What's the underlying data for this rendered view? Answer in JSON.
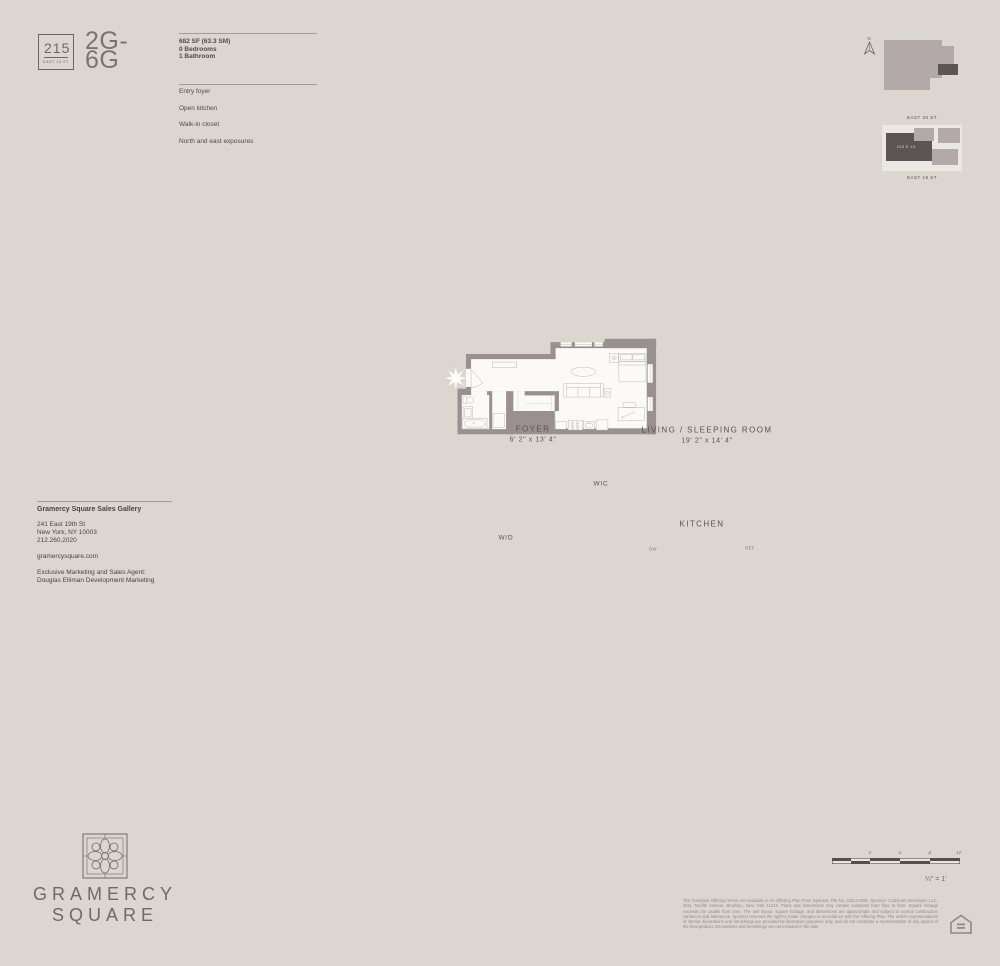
{
  "colors": {
    "background": "#dbd7d0",
    "wall": "#9b9091",
    "interior": "#fbfaf7",
    "keyplan_light": "#b3a9a8",
    "keyplan_dark": "#5c5455",
    "text_dark": "#4e4a45",
    "text_muted": "#8e8a85"
  },
  "header": {
    "badge": {
      "number": "215",
      "street": "EAST 19 ST"
    },
    "unit_name_line1": "2G-",
    "unit_name_line2": "6G",
    "area": "682 SF (63.3 SM)",
    "bedrooms": "0 Bedrooms",
    "bathrooms": "1 Bathroom",
    "features": [
      "Entry foyer",
      "Open kitchen",
      "Walk-in closet",
      "North and east exposures"
    ]
  },
  "keyplan": {
    "north": "N",
    "street_top": "EAST 20 ST",
    "street_bottom": "EAST 19 ST",
    "building": "215 E 19"
  },
  "floorplan": {
    "foyer_label": "FOYER",
    "foyer_dims": "6' 2\" x 13' 4\"",
    "living_label": "LIVING / SLEEPING ROOM",
    "living_dims": "19' 2\" x 14' 4\"",
    "kitchen_label": "KITCHEN",
    "wic_label": "WIC",
    "wd_label": "W/D",
    "dw_label": "DW",
    "ref_label": "REF"
  },
  "contact": {
    "title": "Gramercy Square Sales Gallery",
    "address_line1": "241 East 19th St",
    "address_line2": "New York, NY 10003",
    "phone": "212.260.2020",
    "website": "gramercysquare.com",
    "agent_line1": "Exclusive Marketing and Sales Agent:",
    "agent_line2": "Douglas Elliman Development Marketing"
  },
  "brand": {
    "name_line1": "GRAMERCY",
    "name_line2": "SQUARE"
  },
  "scalebar": {
    "labels": [
      "2'",
      "4'",
      "8'",
      "12'"
    ],
    "ratio": "¼\" = 1'"
  },
  "legal": {
    "disclaimer": "The Complete Offering Terms Are Available In An Offering Plan From Sponsor. File No. CD14-0380. Sponsor: CabGram Developer, LLC, 4611 Twelfth Avenue, Brooklyn, New York 11219. Plans and dimensions may contain variations from floor to floor. Square footage exceeds the usable floor area. The unit layout, square footage, and dimensions are approximate and subject to normal construction variances and tolerances. Sponsor reserves the right to make changes in accordance with the Offering Plan. The artist's representations of interior decorations and furnishings are provided for illustrative purposes only, and do not constitute a representation of any aspect of the final product. Decorations and furnishings are not included in the sale."
  }
}
